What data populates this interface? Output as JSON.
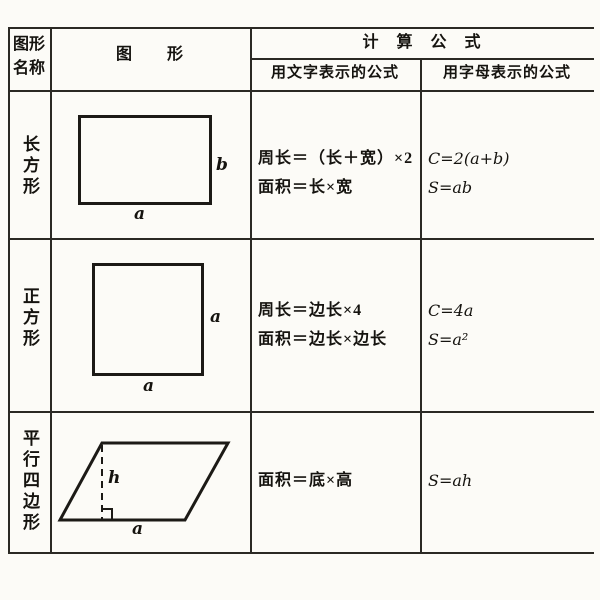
{
  "table": {
    "header": {
      "shape_name_col": "图形名称",
      "figure_col": "图　　形",
      "formula_group": "计　算　公　式",
      "word_formula_col": "用文字表示的公式",
      "letter_formula_col": "用字母表示的公式"
    },
    "rows": [
      {
        "name": "长方形",
        "shape": "rectangle",
        "labels": {
          "side": "b",
          "base": "a"
        },
        "word_formulas": [
          "周长＝（长＋宽）×2",
          "面积＝长×宽"
        ],
        "letter_formulas": [
          "C=2(a+b)",
          "S=ab"
        ]
      },
      {
        "name": "正方形",
        "shape": "square",
        "labels": {
          "side": "a",
          "base": "a"
        },
        "word_formulas": [
          "周长＝边长×4",
          "面积＝边长×边长"
        ],
        "letter_formulas": [
          "C=4a",
          "S=a²"
        ]
      },
      {
        "name": "平行四边形",
        "shape": "parallelogram",
        "labels": {
          "height": "h",
          "base": "a"
        },
        "word_formulas": [
          "面积＝底×高"
        ],
        "letter_formulas": [
          "S=ah"
        ]
      }
    ]
  },
  "colors": {
    "paper": "#fcfbf7",
    "ink": "#15130f",
    "rule": "#2b2924"
  }
}
